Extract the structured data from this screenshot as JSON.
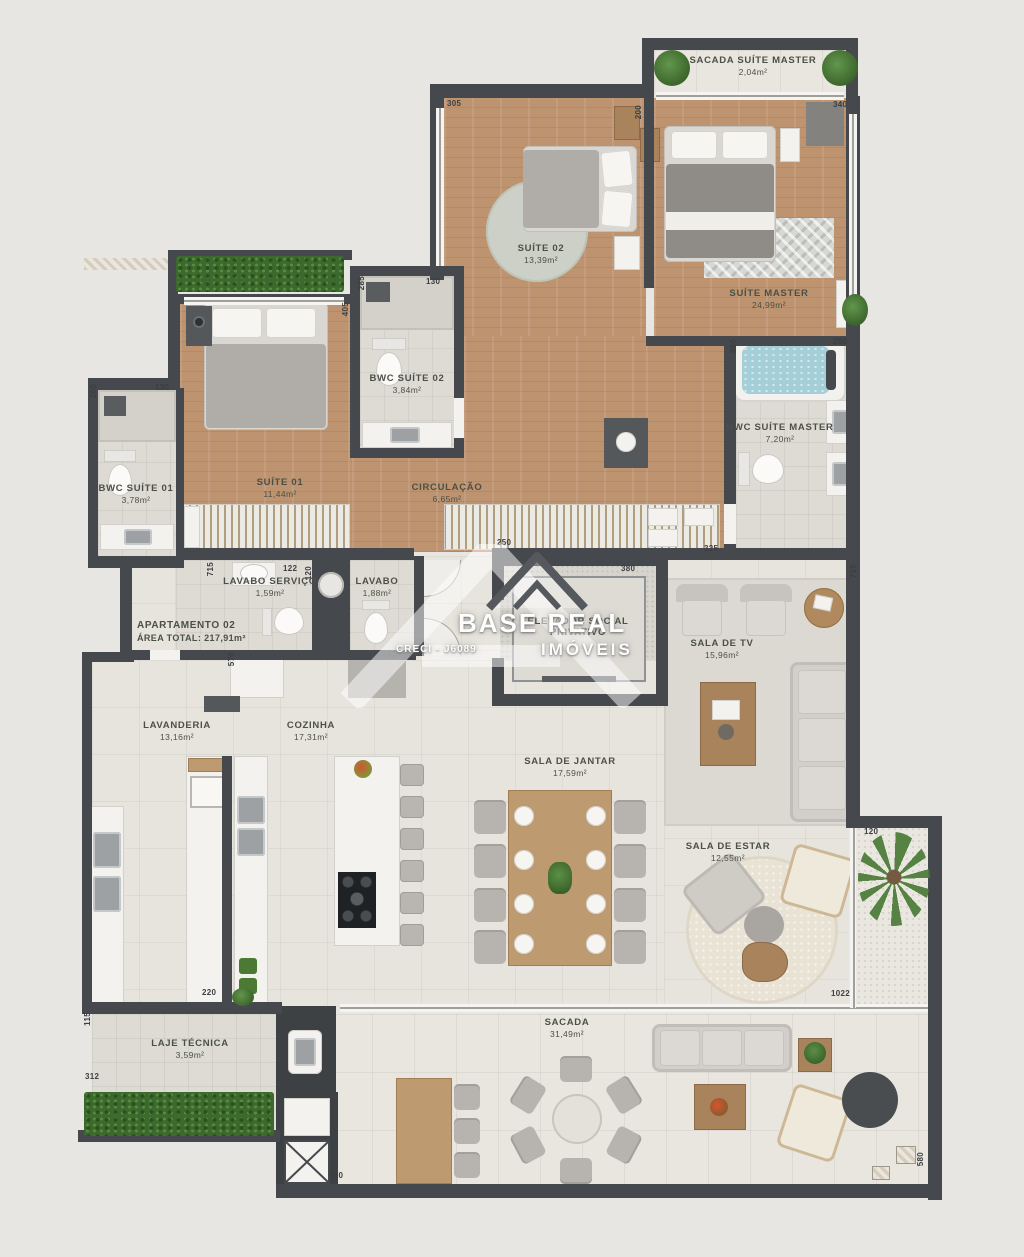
{
  "title_block": {
    "apartment": "APARTAMENTO 02",
    "area_total": "ÁREA TOTAL: 217,91m²"
  },
  "watermark": {
    "brand_top": "BASE REAL",
    "brand_bottom": "IMÓVEIS",
    "creci": "CRECI - J6089"
  },
  "rooms": [
    {
      "name": "SACADA SUÍTE MASTER",
      "area": "2,04m²"
    },
    {
      "name": "SUÍTE 02",
      "area": "13,39m²"
    },
    {
      "name": "SUÍTE MASTER",
      "area": "24,99m²"
    },
    {
      "name": "BWC SUÍTE 02",
      "area": "3,84m²"
    },
    {
      "name": "BWC SUÍTE 01",
      "area": "3,78m²"
    },
    {
      "name": "SUÍTE 01",
      "area": "11,44m²"
    },
    {
      "name": "CIRCULAÇÃO",
      "area": "6,65m²"
    },
    {
      "name": "BWC SUÍTE MASTER",
      "area": "7,20m²"
    },
    {
      "name": "LAVABO SERVIÇO",
      "area": "1,59m²"
    },
    {
      "name": "LAVABO",
      "area": "1,88m²"
    },
    {
      "name": "ELEVADOR SOCIAL",
      "area": "PRIVATIVO"
    },
    {
      "name": "SALA DE TV",
      "area": "15,96m²"
    },
    {
      "name": "LAVANDERIA",
      "area": "13,16m²"
    },
    {
      "name": "COZINHA",
      "area": "17,31m²"
    },
    {
      "name": "SALA DE JANTAR",
      "area": "17,59m²"
    },
    {
      "name": "SALA DE ESTAR",
      "area": "12,55m²"
    },
    {
      "name": "LAJE TÉCNICA",
      "area": "3,59m²"
    },
    {
      "name": "SACADA",
      "area": "31,49m²"
    }
  ],
  "dims": [
    "305",
    "340",
    "200",
    "130",
    "285",
    "405",
    "130",
    "260",
    "715",
    "122",
    "120",
    "570",
    "282",
    "380",
    "250",
    "325",
    "360",
    "200",
    "715",
    "120",
    "220",
    "115",
    "312",
    "1022",
    "980",
    "580"
  ],
  "colors": {
    "wall": "#45484c",
    "wood_floor": "#bd9370",
    "tile_floor": "#e7e4dd",
    "bath_floor": "#dedbd5",
    "hedge_green": "#3c6a2e",
    "tub_water": "#a5cfd8",
    "label_text": "#4b5045"
  }
}
